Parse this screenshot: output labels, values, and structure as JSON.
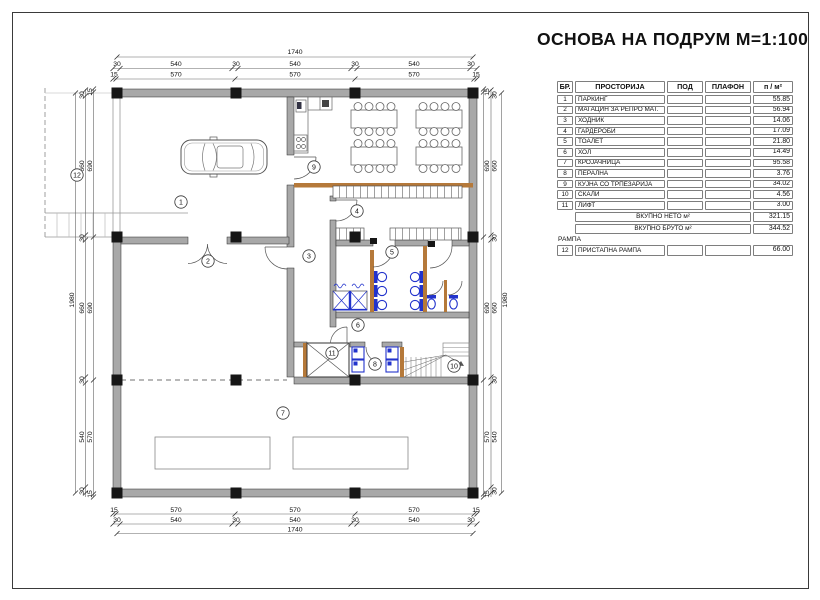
{
  "title": "ОСНОВА НА ПОДРУМ М=1:100",
  "table": {
    "headers": [
      "БР.",
      "ПРОСТОРИЈА",
      "ПОД",
      "ПЛАФОН",
      "п / м²"
    ],
    "rows": [
      {
        "no": "1",
        "name": "ПАРКИНГ",
        "pod": "",
        "plafon": "",
        "area": "55.85"
      },
      {
        "no": "2",
        "name": "МАГАЦИН ЗА РЕПРО МАТ.",
        "pod": "",
        "plafon": "",
        "area": "56.94"
      },
      {
        "no": "3",
        "name": "ХОДНИК",
        "pod": "",
        "plafon": "",
        "area": "14.06"
      },
      {
        "no": "4",
        "name": "ГАРДЕРОБИ",
        "pod": "",
        "plafon": "",
        "area": "17.09"
      },
      {
        "no": "5",
        "name": "ТОАЛЕТ",
        "pod": "",
        "plafon": "",
        "area": "21.80"
      },
      {
        "no": "6",
        "name": "ХОЛ",
        "pod": "",
        "plafon": "",
        "area": "14.49"
      },
      {
        "no": "7",
        "name": "КРОЈАЧНИЦА",
        "pod": "",
        "plafon": "",
        "area": "95.58"
      },
      {
        "no": "8",
        "name": "ПЕРАЛНА",
        "pod": "",
        "plafon": "",
        "area": "3.76"
      },
      {
        "no": "9",
        "name": "КУЈНА СО ТРПЕЗАРИЈА",
        "pod": "",
        "plafon": "",
        "area": "34.02"
      },
      {
        "no": "10",
        "name": "СКАЛИ",
        "pod": "",
        "plafon": "",
        "area": "4.56"
      },
      {
        "no": "11",
        "name": "ЛИФТ",
        "pod": "",
        "plafon": "",
        "area": "3.00"
      }
    ],
    "totals": [
      {
        "label": "ВКУПНО НЕТО м²",
        "value": "321.15"
      },
      {
        "label": "ВКУПНО БРУТО м²",
        "value": "344.52"
      }
    ],
    "ramp_section_label": "РАМПА",
    "ramp_row": {
      "no": "12",
      "name": "ПРИСТАПНА РАМПА",
      "pod": "",
      "plafon": "",
      "area": "66.00"
    }
  },
  "room_labels": [
    {
      "no": "1",
      "x": 181,
      "y": 202
    },
    {
      "no": "2",
      "x": 208,
      "y": 261
    },
    {
      "no": "3",
      "x": 309,
      "y": 256
    },
    {
      "no": "4",
      "x": 357,
      "y": 211
    },
    {
      "no": "5",
      "x": 392,
      "y": 252
    },
    {
      "no": "6",
      "x": 358,
      "y": 325
    },
    {
      "no": "7",
      "x": 283,
      "y": 413
    },
    {
      "no": "8",
      "x": 375,
      "y": 364
    },
    {
      "no": "9",
      "x": 314,
      "y": 167
    },
    {
      "no": "10",
      "x": 454,
      "y": 366
    },
    {
      "no": "11",
      "x": 332,
      "y": 353
    },
    {
      "no": "12",
      "x": 77,
      "y": 175
    }
  ],
  "dim_labels_h": [
    [
      295,
      54,
      "1740"
    ],
    [
      117,
      66,
      "30"
    ],
    [
      176,
      66,
      "540"
    ],
    [
      236,
      66,
      "30"
    ],
    [
      295,
      66,
      "540"
    ],
    [
      355,
      66,
      "30"
    ],
    [
      414,
      66,
      "540"
    ],
    [
      471,
      66,
      "30"
    ],
    [
      114,
      76.5,
      "15"
    ],
    [
      176,
      76.5,
      "570"
    ],
    [
      295,
      76.5,
      "570"
    ],
    [
      414,
      76.5,
      "570"
    ],
    [
      476,
      76.5,
      "15"
    ],
    [
      114,
      512,
      "15"
    ],
    [
      176,
      512,
      "570"
    ],
    [
      295,
      512,
      "570"
    ],
    [
      414,
      512,
      "570"
    ],
    [
      476,
      512,
      "15"
    ],
    [
      117,
      522,
      "30"
    ],
    [
      176,
      522,
      "540"
    ],
    [
      236,
      522,
      "30"
    ],
    [
      295,
      522,
      "540"
    ],
    [
      355,
      522,
      "30"
    ],
    [
      414,
      522,
      "540"
    ],
    [
      471,
      522,
      "30"
    ],
    [
      295,
      531.5,
      "1740"
    ]
  ],
  "dim_labels_v": [
    [
      74,
      300,
      "1980"
    ],
    [
      84,
      95,
      "30"
    ],
    [
      84,
      166,
      "660"
    ],
    [
      84,
      238,
      "30"
    ],
    [
      84,
      308,
      "660"
    ],
    [
      84,
      380,
      "30"
    ],
    [
      84,
      437,
      "540"
    ],
    [
      84,
      491,
      "30"
    ],
    [
      92,
      92,
      "15"
    ],
    [
      92,
      166,
      "690"
    ],
    [
      92,
      308,
      "690"
    ],
    [
      92,
      437,
      "570"
    ],
    [
      92,
      494,
      "15"
    ],
    [
      489,
      92,
      "15"
    ],
    [
      489,
      166,
      "690"
    ],
    [
      489,
      308,
      "690"
    ],
    [
      489,
      437,
      "570"
    ],
    [
      489,
      494,
      "15"
    ],
    [
      496.5,
      95,
      "30"
    ],
    [
      496.5,
      166,
      "660"
    ],
    [
      496.5,
      238,
      "30"
    ],
    [
      496.5,
      308,
      "660"
    ],
    [
      496.5,
      380,
      "30"
    ],
    [
      496.5,
      437,
      "540"
    ],
    [
      496.5,
      491,
      "30"
    ],
    [
      507,
      300,
      "1980"
    ]
  ]
}
